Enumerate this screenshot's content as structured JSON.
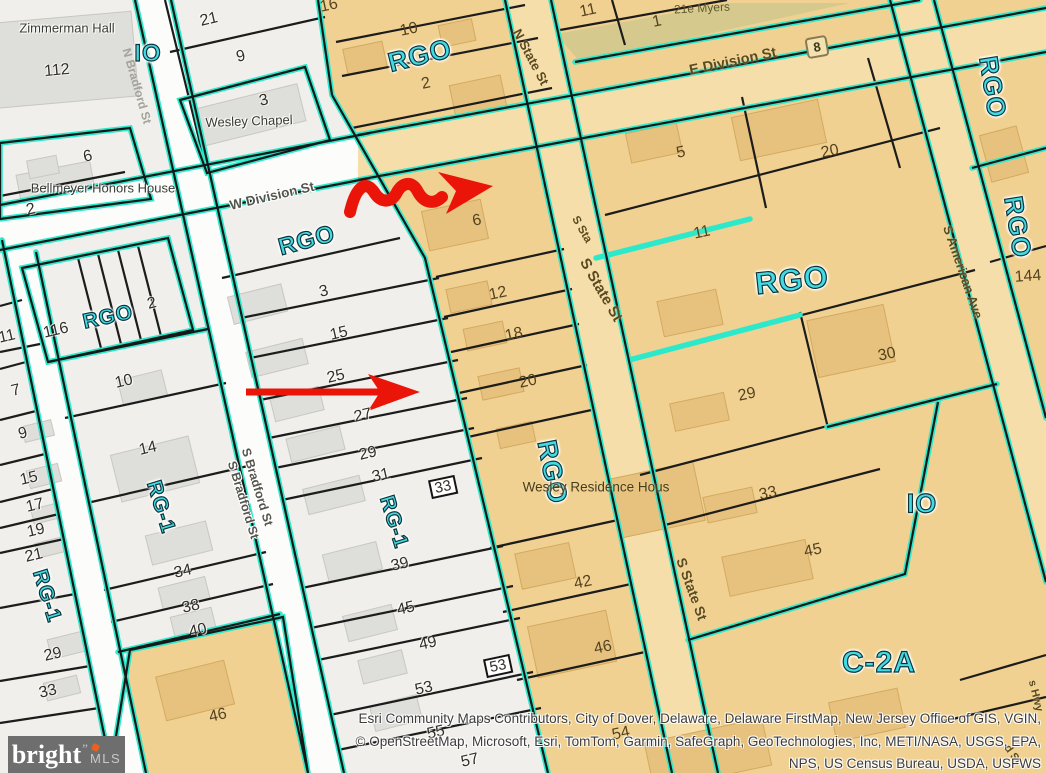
{
  "map": {
    "colors": {
      "parcel_tan": "#F0D191",
      "parcel_gray": "#F0EFEB",
      "boundary_teal": "#2CE9CB",
      "annotation_red": "#EA1508",
      "zone_text": "#43DBE3"
    },
    "zones": {
      "rgo": "RGO",
      "io": "IO",
      "rg1": "RG-1",
      "c2a": "C-2A"
    },
    "streets": {
      "n_bradford": "N Bradford St",
      "s_bradford": "S Bradford St",
      "w_division": "W Division St",
      "e_division": "E Division St",
      "n_state": "N State St",
      "s_state": "S State St",
      "s_state_short": "S Sta",
      "s_american": "S American Ave",
      "hwy_partial": "s Hwy",
      "st_partial": "d St"
    },
    "route_shield": "8",
    "buildings": {
      "zimmerman_hall": "Zimmerman Hall",
      "wesley_chapel": "Wesley Chapel",
      "bellmeyer": "Bellmeyer Honors House",
      "wesley_residence": "Wesley Residence Hous",
      "myers": "21e Myers"
    },
    "parcels": {
      "a1": "112",
      "a2": "21",
      "a3": "9",
      "a4": "3",
      "a5": "6",
      "a6": "2",
      "b1": "11",
      "b2": "116",
      "b3": "2",
      "b4": "7",
      "b5": "10",
      "b6": "9",
      "b7": "14",
      "b8": "15",
      "b9": "17",
      "b10": "19",
      "b11": "21",
      "b12": "29",
      "b13": "33",
      "b14": "34",
      "b15": "38",
      "b16": "40",
      "b17": "46",
      "c1": "3",
      "c2": "15",
      "c3": "25",
      "c4": "27",
      "c5": "29",
      "c6": "31",
      "c7": "33",
      "c8": "39",
      "c9": "45",
      "c10": "49",
      "c11": "53",
      "c12": "53",
      "c13": "55",
      "c14": "57",
      "d1": "16",
      "d2": "10",
      "d3": "2",
      "d4": "6",
      "d5": "12",
      "d6": "18",
      "d7": "20",
      "d8": "42",
      "d9": "46",
      "d10": "54",
      "e1": "11",
      "e2": "1",
      "e3": "5",
      "e4": "20",
      "e5": "11",
      "e6": "29",
      "e7": "30",
      "e8": "33",
      "e9": "45",
      "f1": "144"
    },
    "attribution": {
      "line1": "Esri Community Maps Contributors, City of Dover, Delaware, Delaware FirstMap, New Jersey Office of GIS, VGIN,",
      "line2": "© OpenStreetMap, Microsoft, Esri, TomTom, Garmin, SafeGraph, GeoTechnologies, Inc, METI/NASA, USGS, EPA,",
      "line3": "NPS, US Census Bureau, USDA, USFWS"
    },
    "logo": {
      "name": "bright",
      "mark": "”",
      "suffix": "MLS"
    }
  }
}
